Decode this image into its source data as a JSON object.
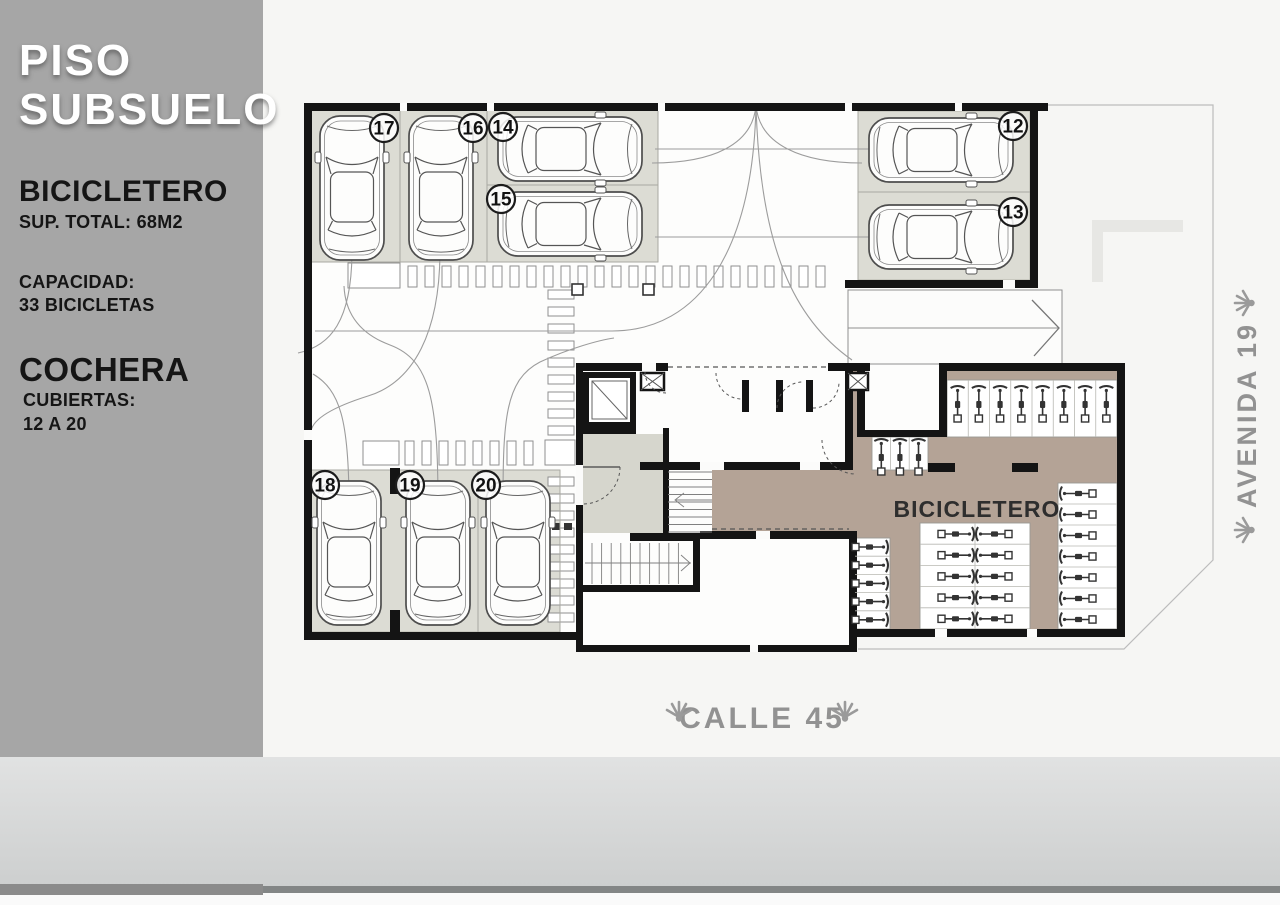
{
  "sidebar": {
    "title_line1": "PISO",
    "title_line2": "SUBSUELO",
    "section1_title": "BICICLETERO",
    "section1_sub": "SUP. TOTAL: 68M2",
    "capacity_label": "CAPACIDAD:",
    "capacity_value": "33 BICICLETAS",
    "section2_title": "COCHERA",
    "covered_label": "CUBIERTAS:",
    "covered_value": "12 A 20"
  },
  "plan": {
    "bicicletero_label": "BICICLETERO",
    "street_bottom": "CALLE 45",
    "street_right": "AVENIDA 19",
    "spots": [
      "17",
      "16",
      "14",
      "15",
      "12",
      "13",
      "18",
      "19",
      "20"
    ]
  },
  "colors": {
    "sidebar_bg": "#a6a6a6",
    "paper": "#f6f6f4",
    "stall_fill": "#dcdcd4",
    "bicicletero_floor": "#b4a396",
    "lobby_floor": "#d6d6cd",
    "wall": "#141414",
    "street_text": "#929292",
    "podium_band": "#d3d5d5"
  }
}
